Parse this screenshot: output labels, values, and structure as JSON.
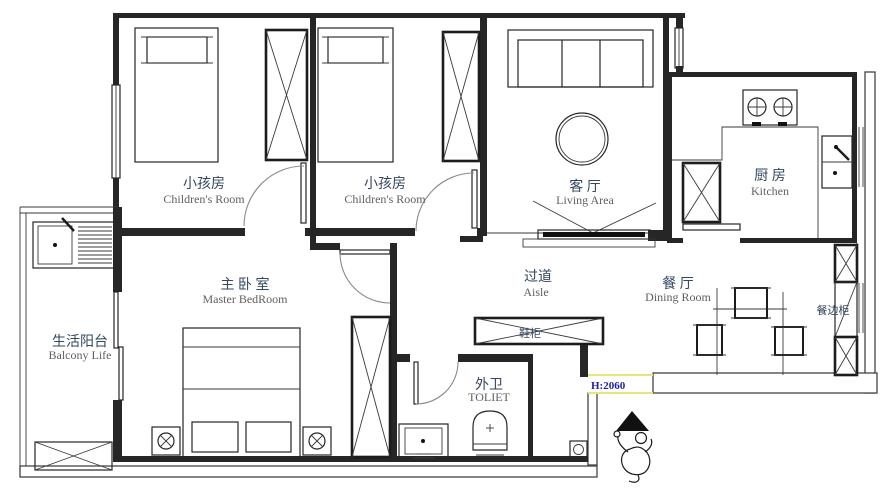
{
  "title": "Apartment Floor Plan",
  "rooms": {
    "children_room_1": {
      "name_cn": "小孩房",
      "name_en": "Children's Room"
    },
    "children_room_2": {
      "name_cn": "小孩房",
      "name_en": "Children's Room"
    },
    "living_area": {
      "name_cn": "客 厅",
      "name_en": "Living Area"
    },
    "kitchen": {
      "name_cn": "厨 房",
      "name_en": "Kitchen"
    },
    "master_bedroom": {
      "name_cn": "主 卧 室",
      "name_en": "Master BedRoom"
    },
    "aisle": {
      "name_cn": "过道",
      "name_en": "Aisle"
    },
    "dining_room": {
      "name_cn": "餐 厅",
      "name_en": "Dining Room"
    },
    "balcony": {
      "name_cn": "生活阳台",
      "name_en": "Balcony Life"
    },
    "toilet": {
      "name_cn": "外卫",
      "name_en": "TOLIET"
    }
  },
  "fixtures": {
    "shoe_cabinet": {
      "label": "鞋柜"
    },
    "sideboard": {
      "label": "餐边柜"
    }
  },
  "annotations": {
    "door_height": "H:2060"
  },
  "colors": {
    "wall": "#262626",
    "label_cn": "#33475e",
    "label_en": "#5f5f5f",
    "annotation": "#2222aa",
    "highlight": "#e6e67a"
  }
}
